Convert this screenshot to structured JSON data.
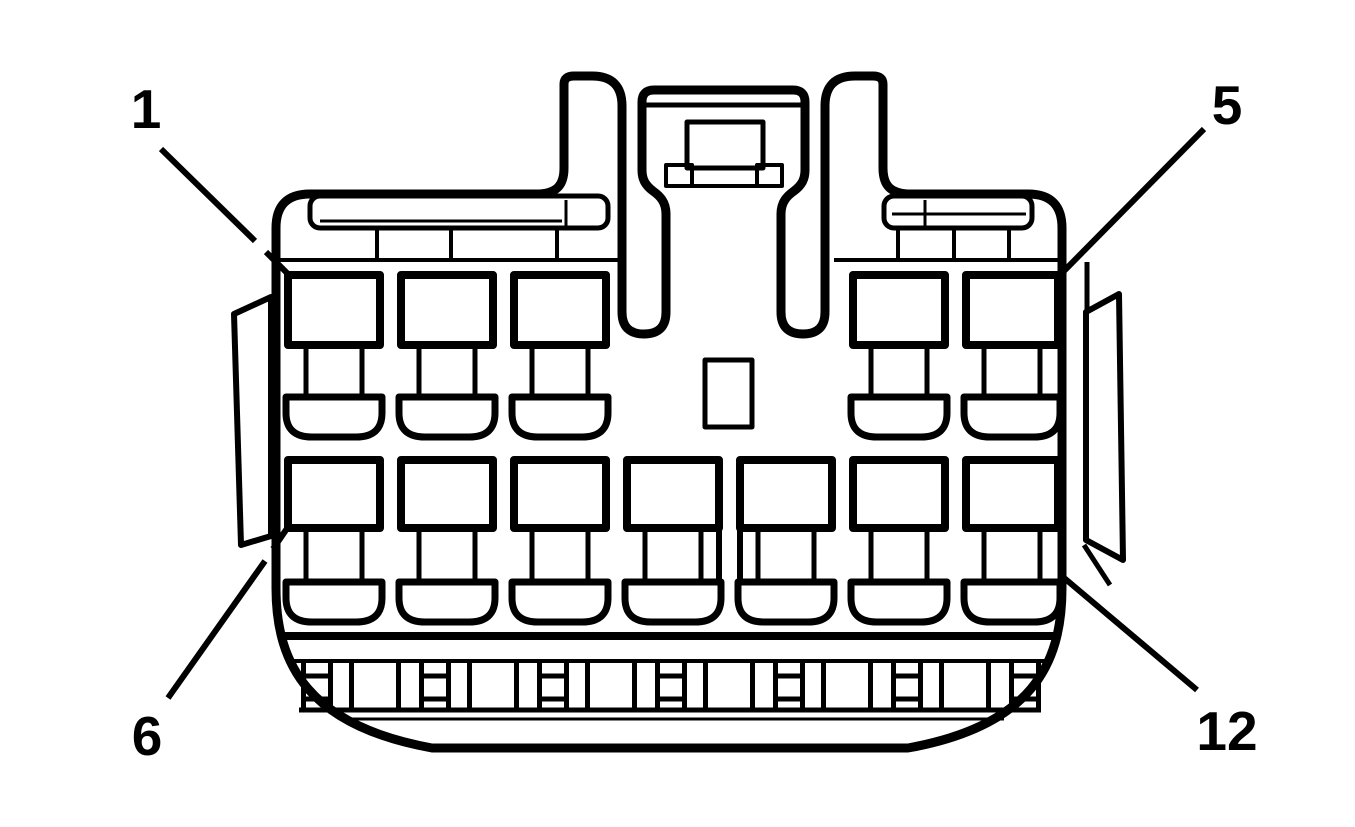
{
  "diagram": {
    "kind": "connector-pinout-face-view",
    "background_color": "#ffffff",
    "line_color": "#000000",
    "pin_labels": {
      "top_left": "1",
      "top_right": "5",
      "bottom_left": "6",
      "bottom_right": "12"
    },
    "pin_rows": [
      {
        "position": "top",
        "pin_count": 5,
        "first_pin_label": "1",
        "last_pin_label": "5"
      },
      {
        "position": "bottom",
        "pin_count": 7,
        "first_pin_label": "6",
        "last_pin_label": "12"
      }
    ]
  }
}
